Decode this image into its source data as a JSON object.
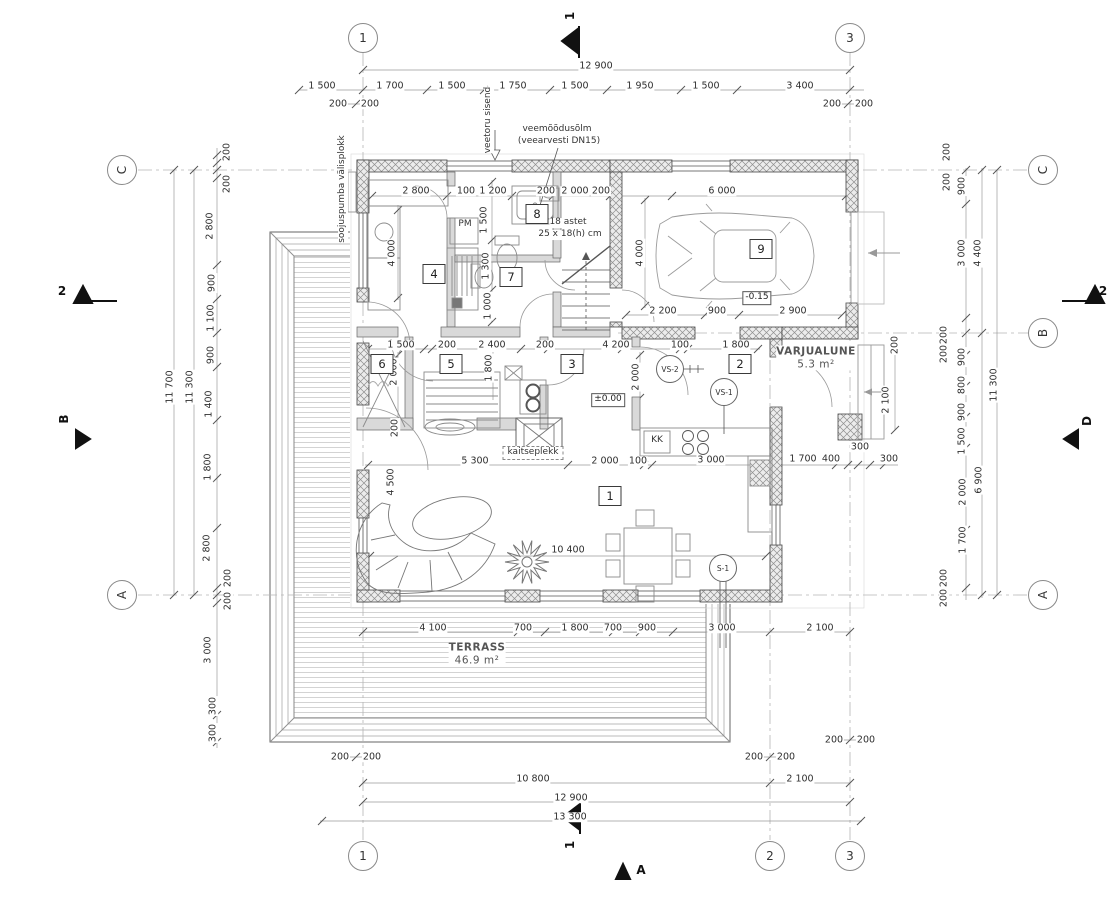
{
  "drawing": {
    "grid_bubbles": [
      {
        "label": "1",
        "x": 363,
        "y": 38,
        "r": 0
      },
      {
        "label": "3",
        "x": 850,
        "y": 38,
        "r": 0
      },
      {
        "label": "1",
        "x": 363,
        "y": 856,
        "r": 0
      },
      {
        "label": "2",
        "x": 770,
        "y": 856,
        "r": 0
      },
      {
        "label": "3",
        "x": 850,
        "y": 856,
        "r": 0
      },
      {
        "label": "C",
        "x": 122,
        "y": 170,
        "r": 1
      },
      {
        "label": "A",
        "x": 122,
        "y": 595,
        "r": 1
      },
      {
        "label": "C",
        "x": 1043,
        "y": 170,
        "r": 1
      },
      {
        "label": "B",
        "x": 1043,
        "y": 333,
        "r": 1
      },
      {
        "label": "A",
        "x": 1043,
        "y": 595,
        "r": 1
      }
    ],
    "section_markers": [
      {
        "label": "1",
        "x": 570,
        "y": 16,
        "r": 1
      },
      {
        "label": "1",
        "x": 570,
        "y": 845,
        "r": 1
      },
      {
        "label": "2",
        "x": 62,
        "y": 291,
        "r": 0
      },
      {
        "label": "2",
        "x": 1103,
        "y": 291,
        "r": 0
      },
      {
        "label": "A",
        "x": 641,
        "y": 870,
        "r": 0
      },
      {
        "label": "B",
        "x": 64,
        "y": 419,
        "r": 1
      },
      {
        "label": "D",
        "x": 1087,
        "y": 421,
        "r": 1
      }
    ],
    "room_numbers": [
      {
        "label": "1",
        "x": 610,
        "y": 496
      },
      {
        "label": "2",
        "x": 740,
        "y": 364
      },
      {
        "label": "3",
        "x": 572,
        "y": 364
      },
      {
        "label": "4",
        "x": 434,
        "y": 274
      },
      {
        "label": "5",
        "x": 451,
        "y": 364
      },
      {
        "label": "6",
        "x": 382,
        "y": 364
      },
      {
        "label": "7",
        "x": 511,
        "y": 277
      },
      {
        "label": "8",
        "x": 537,
        "y": 214
      },
      {
        "label": "9",
        "x": 761,
        "y": 249
      }
    ],
    "ref_circles": [
      {
        "label": "VS-2",
        "x": 670,
        "y": 369
      },
      {
        "label": "VS-1",
        "x": 724,
        "y": 392
      },
      {
        "label": "S-1",
        "x": 723,
        "y": 568
      }
    ],
    "level_markers": [
      {
        "label": "±0.00",
        "x": 608,
        "y": 400
      },
      {
        "label": "-0.15",
        "x": 757,
        "y": 298
      }
    ],
    "area_labels": [
      {
        "title": "VARJUALUNE",
        "sub": "5.3 m²",
        "x": 816,
        "y": 358
      },
      {
        "title": "TERRASS",
        "sub": "46.9 m²",
        "x": 477,
        "y": 654
      }
    ],
    "annotations": [
      {
        "text": "veetoru sisend",
        "x": 489,
        "y": 120,
        "r": 1
      },
      {
        "text": "veemõõdusõlm",
        "x": 557,
        "y": 130,
        "r": 0
      },
      {
        "text": "(veearvesti DN15)",
        "x": 559,
        "y": 142,
        "r": 0
      },
      {
        "text": "soojuspumba välisplokk",
        "x": 343,
        "y": 189,
        "r": 1
      },
      {
        "text": "18 astet",
        "x": 568,
        "y": 223,
        "r": 0
      },
      {
        "text": "25 x 18(h) cm",
        "x": 570,
        "y": 235,
        "r": 0
      },
      {
        "text": "kaitseplekk",
        "x": 533,
        "y": 453,
        "r": 0,
        "boxed": true
      },
      {
        "text": "PM",
        "x": 465,
        "y": 225,
        "r": 0
      },
      {
        "text": "KK",
        "x": 657,
        "y": 441,
        "r": 0
      }
    ],
    "dimensions": [
      {
        "t": "12 900",
        "x": 596,
        "y": 66,
        "r": 0
      },
      {
        "t": "1 500",
        "x": 322,
        "y": 86,
        "r": 0
      },
      {
        "t": "1 700",
        "x": 390,
        "y": 86,
        "r": 0
      },
      {
        "t": "1 500",
        "x": 452,
        "y": 86,
        "r": 0
      },
      {
        "t": "1 750",
        "x": 513,
        "y": 86,
        "r": 0
      },
      {
        "t": "1 500",
        "x": 575,
        "y": 86,
        "r": 0
      },
      {
        "t": "1 950",
        "x": 640,
        "y": 86,
        "r": 0
      },
      {
        "t": "1 500",
        "x": 706,
        "y": 86,
        "r": 0
      },
      {
        "t": "3 400",
        "x": 800,
        "y": 86,
        "r": 0
      },
      {
        "t": "200",
        "x": 338,
        "y": 104,
        "r": 0
      },
      {
        "t": "200",
        "x": 370,
        "y": 104,
        "r": 0
      },
      {
        "t": "200",
        "x": 832,
        "y": 104,
        "r": 0
      },
      {
        "t": "200",
        "x": 864,
        "y": 104,
        "r": 0
      },
      {
        "t": "2 800",
        "x": 416,
        "y": 191,
        "r": 0
      },
      {
        "t": "100",
        "x": 466,
        "y": 191,
        "r": 0
      },
      {
        "t": "1 200",
        "x": 493,
        "y": 191,
        "r": 0
      },
      {
        "t": "200",
        "x": 546,
        "y": 191,
        "r": 0
      },
      {
        "t": "2 000",
        "x": 575,
        "y": 191,
        "r": 0
      },
      {
        "t": "200",
        "x": 601,
        "y": 191,
        "r": 0
      },
      {
        "t": "6 000",
        "x": 722,
        "y": 191,
        "r": 0
      },
      {
        "t": "1 500",
        "x": 484,
        "y": 220,
        "r": 1
      },
      {
        "t": "1 300",
        "x": 486,
        "y": 266,
        "r": 1
      },
      {
        "t": "1 000",
        "x": 488,
        "y": 306,
        "r": 1
      },
      {
        "t": "4 000",
        "x": 392,
        "y": 253,
        "r": 1
      },
      {
        "t": "4 000",
        "x": 640,
        "y": 253,
        "r": 1
      },
      {
        "t": "2 200",
        "x": 663,
        "y": 311,
        "r": 0
      },
      {
        "t": "900",
        "x": 717,
        "y": 311,
        "r": 0
      },
      {
        "t": "2 900",
        "x": 793,
        "y": 311,
        "r": 0
      },
      {
        "t": "1 500",
        "x": 401,
        "y": 345,
        "r": 0
      },
      {
        "t": "200",
        "x": 447,
        "y": 345,
        "r": 0
      },
      {
        "t": "2 400",
        "x": 492,
        "y": 345,
        "r": 0
      },
      {
        "t": "200",
        "x": 545,
        "y": 345,
        "r": 0
      },
      {
        "t": "4 200",
        "x": 616,
        "y": 345,
        "r": 0
      },
      {
        "t": "100",
        "x": 680,
        "y": 345,
        "r": 0
      },
      {
        "t": "1 800",
        "x": 736,
        "y": 345,
        "r": 0
      },
      {
        "t": "2 000",
        "x": 394,
        "y": 372,
        "r": 1
      },
      {
        "t": "1 800",
        "x": 489,
        "y": 368,
        "r": 1
      },
      {
        "t": "2 000",
        "x": 636,
        "y": 377,
        "r": 1
      },
      {
        "t": "200",
        "x": 395,
        "y": 428,
        "r": 1
      },
      {
        "t": "200",
        "x": 895,
        "y": 345,
        "r": 1
      },
      {
        "t": "2 100",
        "x": 886,
        "y": 400,
        "r": 1
      },
      {
        "t": "5 300",
        "x": 475,
        "y": 461,
        "r": 0
      },
      {
        "t": "2 000",
        "x": 605,
        "y": 461,
        "r": 0
      },
      {
        "t": "100",
        "x": 638,
        "y": 461,
        "r": 0
      },
      {
        "t": "3 000",
        "x": 711,
        "y": 460,
        "r": 0
      },
      {
        "t": "1 700",
        "x": 803,
        "y": 459,
        "r": 0
      },
      {
        "t": "400",
        "x": 831,
        "y": 459,
        "r": 0
      },
      {
        "t": "300",
        "x": 860,
        "y": 447,
        "r": 0
      },
      {
        "t": "300",
        "x": 889,
        "y": 459,
        "r": 0
      },
      {
        "t": "4 500",
        "x": 391,
        "y": 482,
        "r": 1
      },
      {
        "t": "10 400",
        "x": 568,
        "y": 550,
        "r": 0
      },
      {
        "t": "4 100",
        "x": 433,
        "y": 628,
        "r": 0
      },
      {
        "t": "700",
        "x": 523,
        "y": 628,
        "r": 0
      },
      {
        "t": "1 800",
        "x": 575,
        "y": 628,
        "r": 0
      },
      {
        "t": "700",
        "x": 613,
        "y": 628,
        "r": 0
      },
      {
        "t": "900",
        "x": 647,
        "y": 628,
        "r": 0
      },
      {
        "t": "3 000",
        "x": 722,
        "y": 628,
        "r": 0
      },
      {
        "t": "2 100",
        "x": 820,
        "y": 628,
        "r": 0
      },
      {
        "t": "200",
        "x": 340,
        "y": 757,
        "r": 0
      },
      {
        "t": "200",
        "x": 372,
        "y": 757,
        "r": 0
      },
      {
        "t": "200",
        "x": 754,
        "y": 757,
        "r": 0
      },
      {
        "t": "200",
        "x": 786,
        "y": 757,
        "r": 0
      },
      {
        "t": "200",
        "x": 834,
        "y": 740,
        "r": 0
      },
      {
        "t": "200",
        "x": 866,
        "y": 740,
        "r": 0
      },
      {
        "t": "10 800",
        "x": 533,
        "y": 779,
        "r": 0
      },
      {
        "t": "2 100",
        "x": 800,
        "y": 779,
        "r": 0
      },
      {
        "t": "12 900",
        "x": 571,
        "y": 798,
        "r": 0
      },
      {
        "t": "13 300",
        "x": 570,
        "y": 817,
        "r": 0
      },
      {
        "t": "200",
        "x": 227,
        "y": 152,
        "r": 1
      },
      {
        "t": "200",
        "x": 227,
        "y": 184,
        "r": 1
      },
      {
        "t": "2 800",
        "x": 210,
        "y": 226,
        "r": 1
      },
      {
        "t": "900",
        "x": 212,
        "y": 283,
        "r": 1
      },
      {
        "t": "1 100",
        "x": 211,
        "y": 318,
        "r": 1
      },
      {
        "t": "900",
        "x": 211,
        "y": 355,
        "r": 1
      },
      {
        "t": "1 400",
        "x": 209,
        "y": 404,
        "r": 1
      },
      {
        "t": "1 800",
        "x": 208,
        "y": 467,
        "r": 1
      },
      {
        "t": "2 800",
        "x": 207,
        "y": 548,
        "r": 1
      },
      {
        "t": "200",
        "x": 228,
        "y": 578,
        "r": 1
      },
      {
        "t": "200",
        "x": 228,
        "y": 601,
        "r": 1
      },
      {
        "t": "3 000",
        "x": 208,
        "y": 650,
        "r": 1
      },
      {
        "t": "300",
        "x": 213,
        "y": 706,
        "r": 1
      },
      {
        "t": "300",
        "x": 213,
        "y": 733,
        "r": 1
      },
      {
        "t": "11 700",
        "x": 170,
        "y": 387,
        "r": 1
      },
      {
        "t": "11 300",
        "x": 190,
        "y": 387,
        "r": 1
      },
      {
        "t": "200",
        "x": 947,
        "y": 152,
        "r": 1
      },
      {
        "t": "200",
        "x": 947,
        "y": 182,
        "r": 1
      },
      {
        "t": "900",
        "x": 962,
        "y": 186,
        "r": 1
      },
      {
        "t": "3 000",
        "x": 962,
        "y": 253,
        "r": 1
      },
      {
        "t": "4 400",
        "x": 978,
        "y": 253,
        "r": 1
      },
      {
        "t": "200",
        "x": 944,
        "y": 335,
        "r": 1
      },
      {
        "t": "200",
        "x": 944,
        "y": 354,
        "r": 1
      },
      {
        "t": "900",
        "x": 962,
        "y": 357,
        "r": 1
      },
      {
        "t": "800",
        "x": 962,
        "y": 385,
        "r": 1
      },
      {
        "t": "900",
        "x": 962,
        "y": 412,
        "r": 1
      },
      {
        "t": "1 500",
        "x": 962,
        "y": 441,
        "r": 1
      },
      {
        "t": "2 000",
        "x": 963,
        "y": 492,
        "r": 1
      },
      {
        "t": "1 700",
        "x": 963,
        "y": 540,
        "r": 1
      },
      {
        "t": "200",
        "x": 944,
        "y": 578,
        "r": 1
      },
      {
        "t": "200",
        "x": 944,
        "y": 598,
        "r": 1
      },
      {
        "t": "6 900",
        "x": 979,
        "y": 480,
        "r": 1
      },
      {
        "t": "11 300",
        "x": 994,
        "y": 385,
        "r": 1
      }
    ]
  }
}
